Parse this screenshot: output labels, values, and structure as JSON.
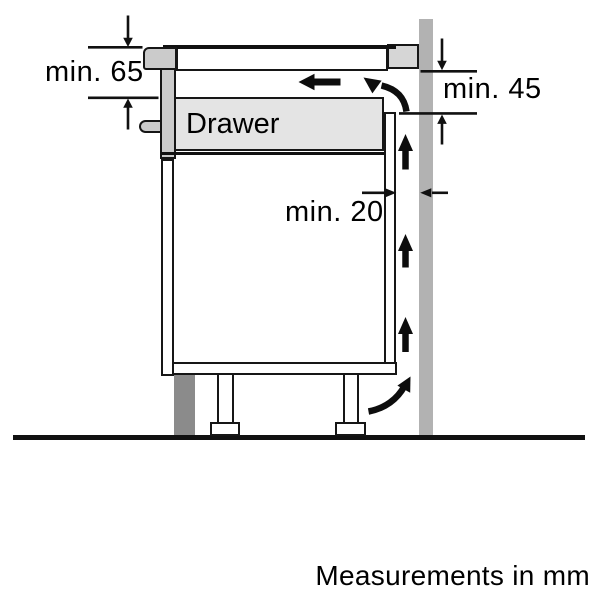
{
  "diagram": {
    "labels": {
      "front_clearance": "min. 65",
      "back_clearance": "min. 45",
      "rear_gap": "min. 20",
      "drawer": "Drawer"
    },
    "footer": "Measurements in mm",
    "colors": {
      "outline": "#111111",
      "wall": "#b2b2b2",
      "worktop": "#d6d6d6",
      "cabinet_front": "#cbcbcb",
      "drawer_fill": "#e4e4e4",
      "plinth": "#8b8b8b"
    }
  }
}
